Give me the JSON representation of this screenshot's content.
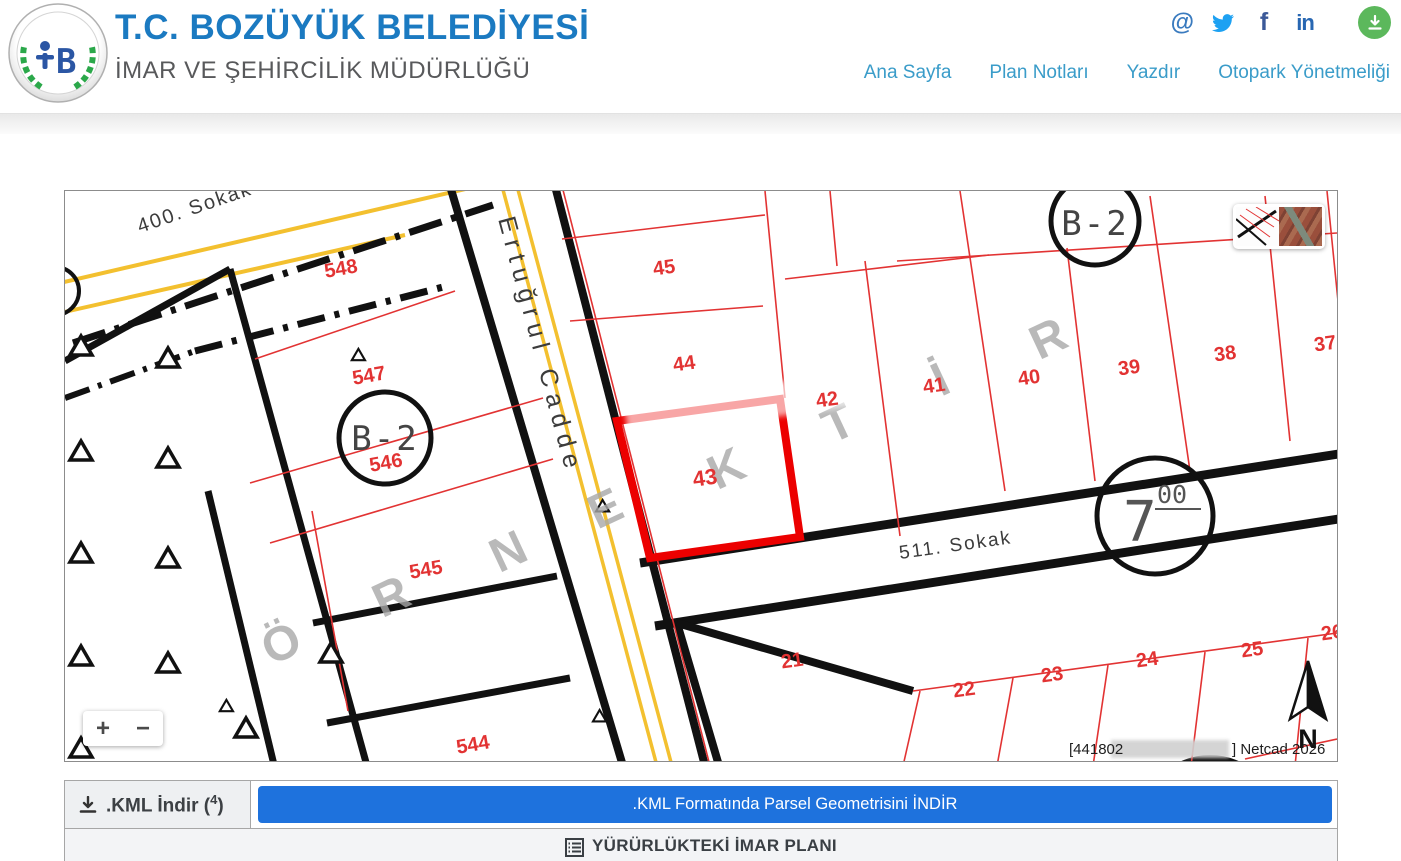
{
  "header": {
    "title": "T.C. BOZÜYÜK BELEDİYESİ",
    "subtitle": "İMAR VE ŞEHİRCİLİK MÜDÜRLÜĞÜ",
    "logo_text": "BOZÜYÜK BELEDİYESİ",
    "nav_items": [
      {
        "label": "Ana Sayfa"
      },
      {
        "label": "Plan Notları"
      },
      {
        "label": "Yazdır"
      },
      {
        "label": "Otopark Yönetmeliği"
      }
    ],
    "social": {
      "at": "@",
      "facebook": "f",
      "linkedin": "in"
    },
    "colors": {
      "title_blue": "#1b7ac1",
      "nav_blue": "#3a9cc9",
      "download_green": "#5cb85c"
    }
  },
  "map": {
    "streets": {
      "s400": "400. Sokak",
      "ertugrul": "Ertuğrul Cadde",
      "s511": "511. Sokak"
    },
    "zones": [
      "B-2",
      "B-2"
    ],
    "road_width": {
      "main": "7",
      "sup": "00"
    },
    "selected_parcel": "43",
    "parcels": {
      "left_block": [
        "548",
        "547",
        "546",
        "545",
        "544"
      ],
      "upper_block": [
        "45",
        "44",
        "43",
        "42",
        "41",
        "40",
        "39",
        "38",
        "37"
      ],
      "lower_block": [
        "21",
        "22",
        "23",
        "24",
        "25",
        "26"
      ]
    },
    "watermark_letters": [
      "Ö",
      "R",
      "N",
      "E",
      "K",
      "T",
      "İ",
      "R"
    ],
    "credit": {
      "prefix": "[441802",
      "suffix": "] Netcad 2026"
    },
    "controls": {
      "zoom_in": "+",
      "zoom_out": "−",
      "north": "N"
    },
    "colors": {
      "parcel_red": "#e23333",
      "selected_red": "#ec0000",
      "road_yellow": "#f3c02f",
      "line_black": "#111111",
      "watermark_gray": "#a8a8a8"
    }
  },
  "actions": {
    "kml_cell": {
      "prefix": ".KML İndir (",
      "count": "4",
      "suffix": ")"
    },
    "kml_button_label": ".KML Formatında Parsel Geometrisini İNDİR"
  },
  "footer": {
    "plan_header": "YÜRÜRLÜKTEKİ İMAR PLANI"
  }
}
